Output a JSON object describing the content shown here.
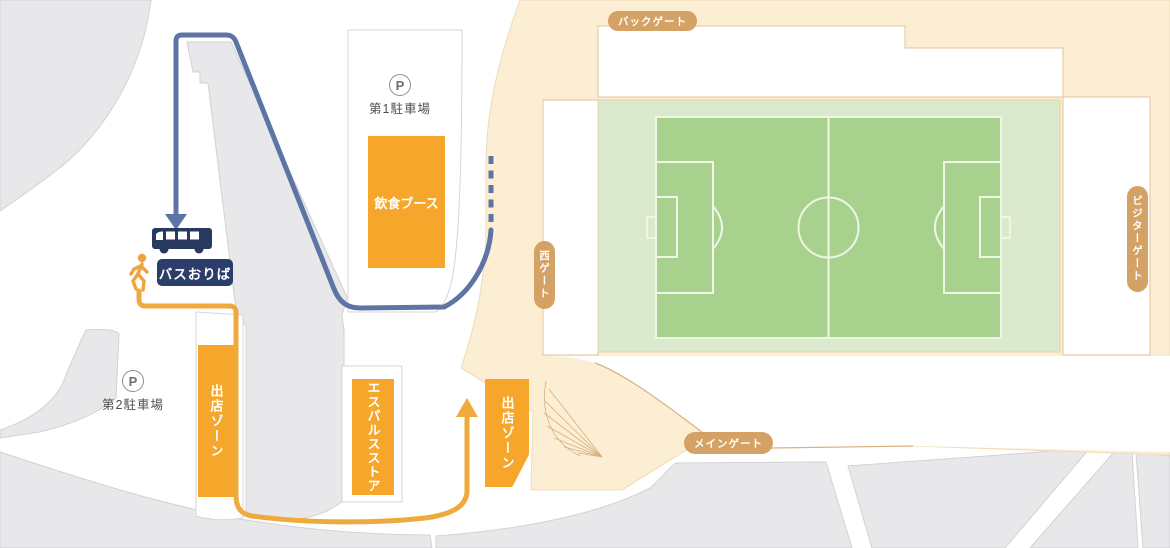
{
  "map": {
    "gates": {
      "back": {
        "label": "バックゲート"
      },
      "west": {
        "label": "西ゲート"
      },
      "visitor": {
        "label": "ビジターゲート"
      },
      "main": {
        "label": "メインゲート"
      }
    },
    "parking": {
      "icon_letter": "P",
      "lot1": {
        "label": "第1駐車場"
      },
      "lot2": {
        "label": "第2駐車場"
      }
    },
    "facilities": {
      "food_booth": {
        "label": "飲食ブース"
      },
      "vendor_zone_left": {
        "label": "出店ゾーン"
      },
      "vendor_zone_right": {
        "label": "出店ゾーン"
      },
      "spulse_store": {
        "label": "エスパルスストア"
      }
    },
    "bus_stop": {
      "label": "バスおりば"
    },
    "colors": {
      "facility_orange": "#f5a62b",
      "gate_tan": "#d5a266",
      "bus_navy": "#2b3e69",
      "route_blue": "#5d74a4",
      "route_orange": "#efaa3d",
      "stadium_cream": "#fbeed3",
      "pitch_green": "#a8d18d",
      "pitch_pale": "#dbe9cc",
      "block_gray": "#e8e8ea"
    }
  }
}
